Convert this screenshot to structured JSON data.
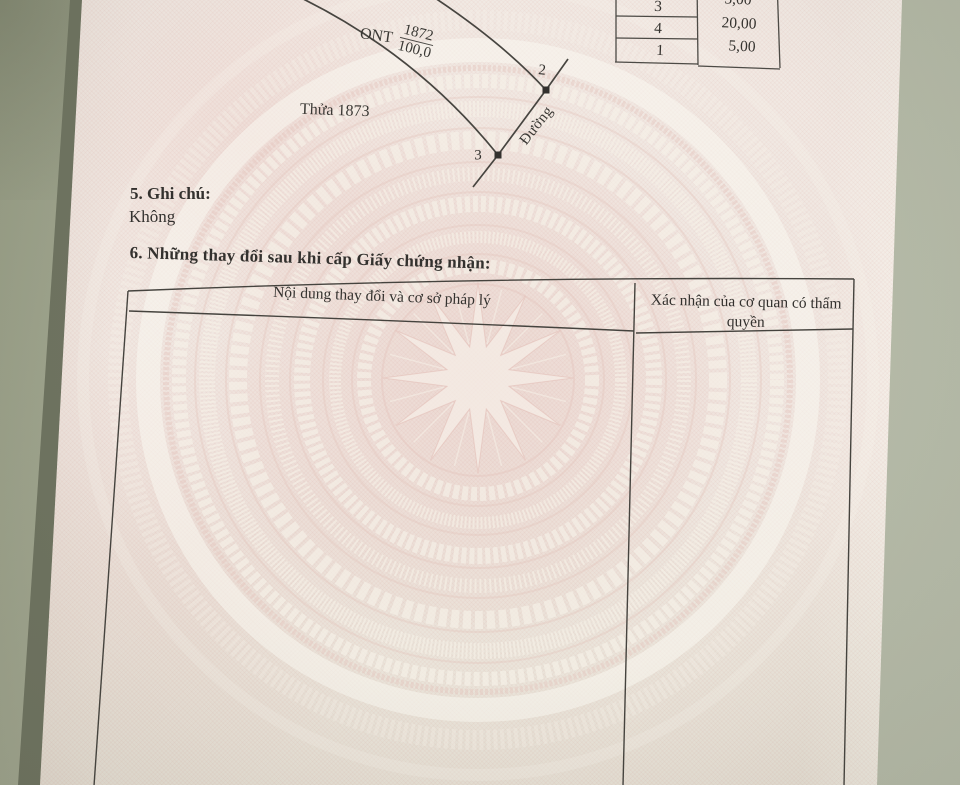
{
  "document_type": "land-certificate-photo",
  "palette": {
    "table_surface": "#a8ad9b",
    "paper": "#f0e7e1",
    "watermark_pink": "#e3c3bb",
    "watermark_cream": "#f6f1e8",
    "rule_line": "#44423f",
    "text": "#33312e"
  },
  "sketch": {
    "land_type": "ONT",
    "parcel_number": "1872",
    "area": "100,0",
    "adjacent_parcel_label": "Thửa 1873",
    "road_label": "Đường",
    "vertex_2": "2",
    "vertex_3": "3"
  },
  "edge_table": {
    "vertices": [
      "3",
      "4",
      "1"
    ],
    "lengths": [
      "5,00",
      "20,00",
      "5,00"
    ]
  },
  "section_5": {
    "heading": "5. Ghi chú:",
    "value": "Không"
  },
  "section_6": {
    "heading": "6. Những thay đổi sau khi cấp Giấy chứng nhận:",
    "table": {
      "col_1_header": "Nội dung thay đổi và cơ sở pháp lý",
      "col_2_header": "Xác nhận của cơ quan có thẩm quyền"
    }
  }
}
